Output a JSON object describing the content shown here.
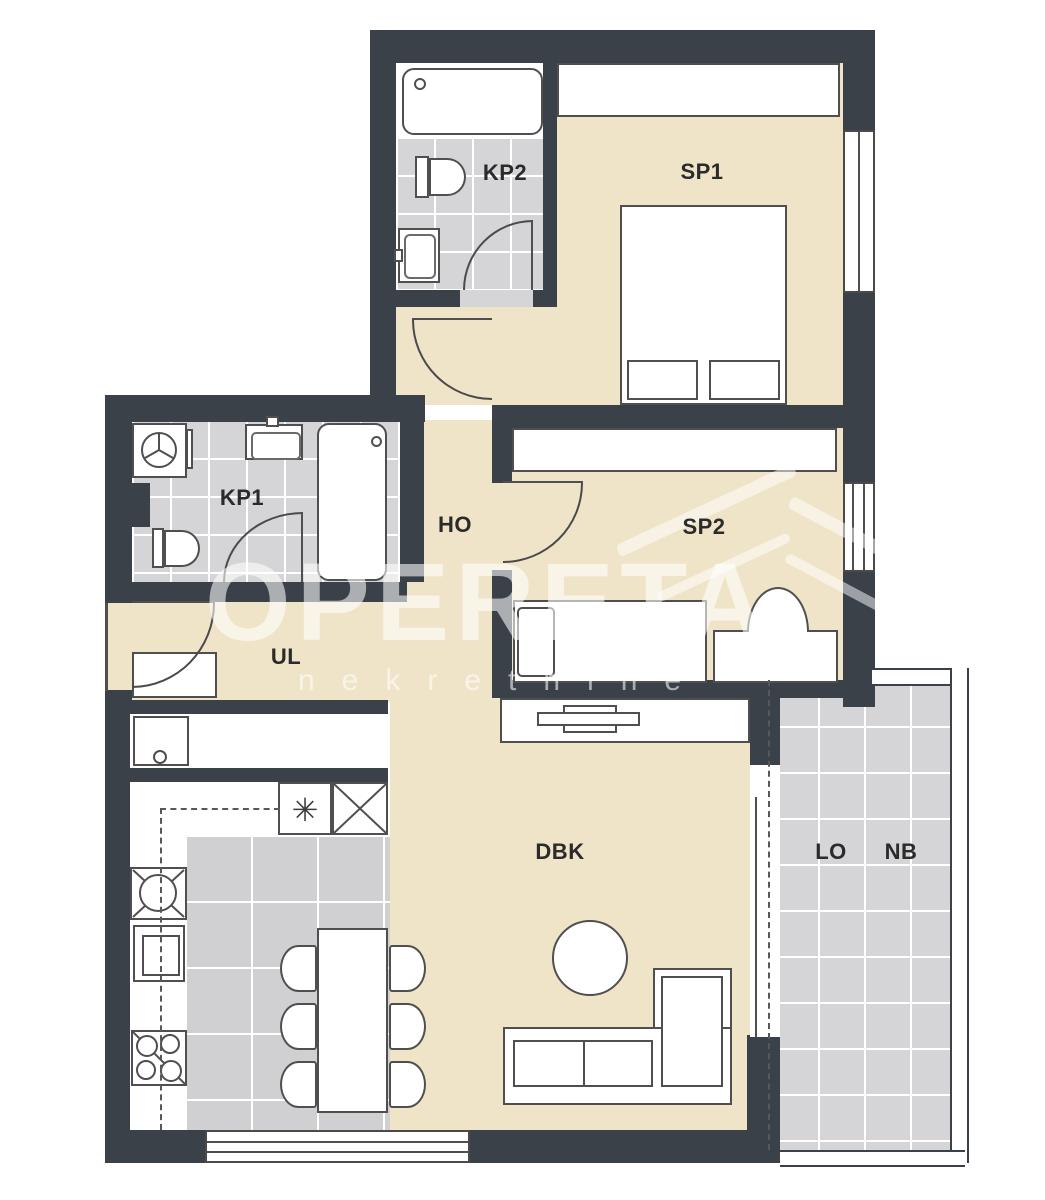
{
  "plan": {
    "title": "apartment-floor-plan",
    "rooms": [
      {
        "id": "kp2",
        "label": "KP2"
      },
      {
        "id": "sp1",
        "label": "SP1"
      },
      {
        "id": "kp1",
        "label": "KP1"
      },
      {
        "id": "ho",
        "label": "HO"
      },
      {
        "id": "sp2",
        "label": "SP2"
      },
      {
        "id": "ul",
        "label": "UL"
      },
      {
        "id": "dbk",
        "label": "DBK"
      },
      {
        "id": "lo",
        "label": "LO"
      },
      {
        "id": "nb",
        "label": "NB"
      }
    ],
    "symbols": {
      "freezer": "✳"
    },
    "watermark": {
      "brand": "OPERETA",
      "subtitle": "nekretnine"
    },
    "colors": {
      "wall": "#3a4149",
      "floor_beige": "#f0e4c8",
      "tile_gray": "#d5d5d7",
      "kitchen_tile": "#d0d0d2",
      "furniture_line": "#4f4f4f",
      "label_text": "#2b2b2b"
    }
  }
}
